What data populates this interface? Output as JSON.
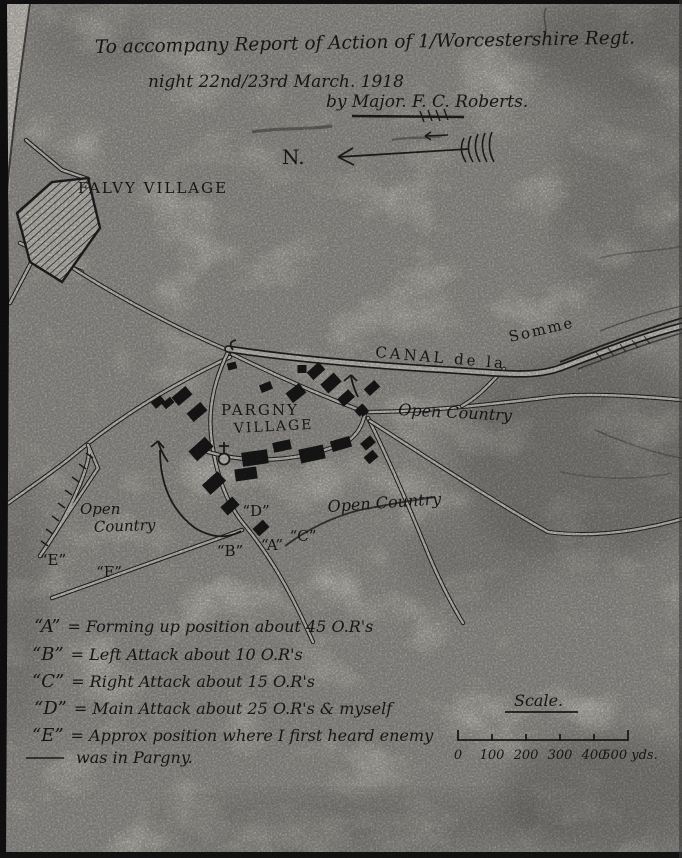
{
  "title": {
    "line1": "To accompany Report of   Action of 1/Worcestershire Regt.",
    "line2": "night 22nd/23rd    March. 1918",
    "line3": "by    Major. F. C. Roberts."
  },
  "map": {
    "north": "N.",
    "falvy": "FALVY VILLAGE",
    "pargny1": "PARGNY",
    "pargny2": "VILLAGE",
    "canal1": "CANAL de la",
    "canal2": "Somme",
    "open_right": "Open Country",
    "open_mid": "Open Country",
    "open_left1": "Open",
    "open_left2": "Country",
    "markers": [
      {
        "id": "A",
        "text": "“A”"
      },
      {
        "id": "B",
        "text": "“B”"
      },
      {
        "id": "C",
        "text": "“C”"
      },
      {
        "id": "D",
        "text": "“D”"
      },
      {
        "id": "E",
        "text": "“E”"
      },
      {
        "id": "F",
        "text": "“F”"
      }
    ]
  },
  "legend": {
    "entries": [
      {
        "key": "“A”",
        "desc": "= Forming up position about 45 O.R's"
      },
      {
        "key": "“B”",
        "desc": "= Left Attack about 10 O.R's"
      },
      {
        "key": "“C”",
        "desc": "= Right Attack about 15 O.R's"
      },
      {
        "key": "“D”",
        "desc": "= Main Attack about 25 O.R's & myself"
      },
      {
        "key": "“E”",
        "desc": "= Approx position where I first heard enemy"
      }
    ],
    "continuation": "was in Pargny."
  },
  "scale": {
    "title": "Scale.",
    "ticks": [
      "0",
      "100",
      "200",
      "300",
      "400",
      "500 yds."
    ]
  }
}
